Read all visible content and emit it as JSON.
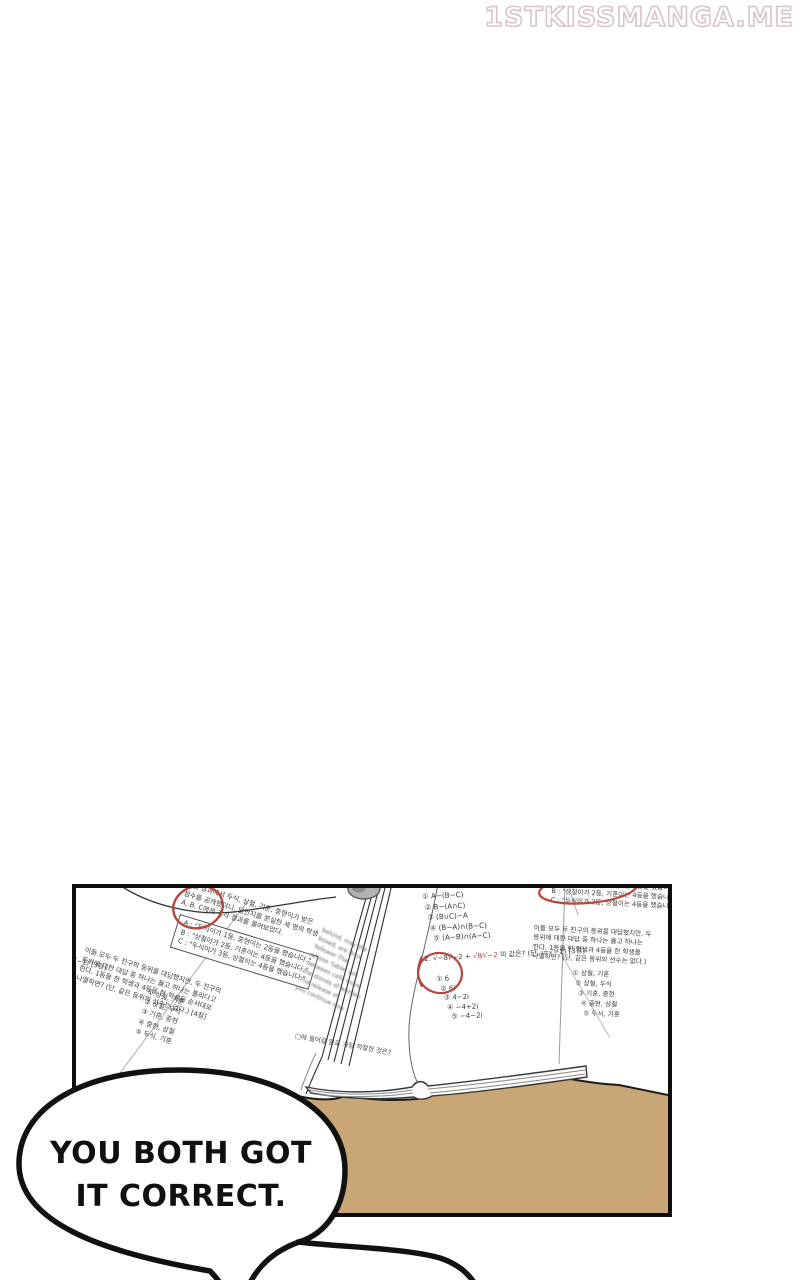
{
  "watermark": "1STKISSMANGA.ME",
  "speech_bubble": {
    "line1": "YOU BOTH GOT",
    "line2": "IT CORRECT."
  },
  "colors": {
    "desk": "#c9a676",
    "red_pen": "#b5473c",
    "panel_border": "#0e0e0e",
    "watermark_outline": "#d6c6c6"
  },
  "panel": {
    "left_paper": {
      "intro_lines": [
        "시험 결과에서 두식, 상철, 기훈, 중현이가 받은",
        "점수를 공개했더니, 답안지를 분실한 세 명의 학생",
        "A, B, C에게 각각 결과를 물어보았다."
      ],
      "statement_box": [
        "A : \"두식이가 1등, 중현이는 2등을 했습니다.\"",
        "B : \"상철이가 2등, 기훈이는 4등을 했습니다.\"",
        "C : \"두식이가 3등, 상철이는 4등을 했습니다.\""
      ],
      "question_lines": [
        "이들 모두 두 친구의 등위를 대답했지만, 두 친구의",
        "등위에 대한 대답 중 하나는 옳고 하나는 틀리다고",
        "한다. 1등을 한 학생과 4등을 한 학생을 순서대로",
        "나열하면? (단, 같은 등위의 선수는 없다.) [4점]"
      ],
      "options": [
        "① 상철, 기훈",
        "② 상철, 두식",
        "③ 기훈, 중현",
        "④ 중현, 상철",
        "⑤ 두식, 기훈"
      ],
      "edge_fragment": "단, i=√−1) [3점]"
    },
    "book_left_page": {
      "blur_lines": [
        "behind, may the",
        "boxed, are Bros",
        "follower The",
        "whose 'table' will",
        "between cells more",
        "the stones of women",
        "The release of",
        "you continue now"
      ],
      "caption": "□에 들어갈 말로 가장 적절한 것은?"
    },
    "book_right_page": {
      "set_options": [
        "① A−(B−C)",
        "② B−(A∩C)",
        "③ (B∪C)−A",
        "④ (B−A)∩(B−C)",
        "⑤ (A−B)∩(A−C)"
      ],
      "problem_prefix": "2.  √−8√−2 + ",
      "problem_fraction": "√8⁄√−2",
      "problem_suffix": " 의 값은? (단, i=√−1) [3점]",
      "number_options": [
        "① 6",
        "② 6i",
        "③ 4−2i",
        "④ −4+2i",
        "⑤ −4−2i"
      ]
    },
    "right_paper": {
      "statements": [
        "A : \"두식이가 1등, 중현이는 2등을 했습니다.\"",
        "B : \"상철이가 2등, 기훈이는 4등을 했습니다.\"",
        "C : \"두식이가 2등, 상철이는 4등을 했습니다.\""
      ],
      "question_lines": [
        "이들 모두 두 친구의 등위를 대답했지만, 두",
        "등위에 대한 대답 중 하나는 옳고 하나는",
        "한다. 1등을 한 학생과 4등을 한 학생을",
        "나열하면? (단, 같은 등위의 선수는 없다.)"
      ],
      "options": [
        "① 상철, 기훈",
        "② 상철, 두식",
        "③ 기훈, 중현",
        "④ 중현, 상철",
        "⑤ 두식, 기훈"
      ]
    }
  }
}
